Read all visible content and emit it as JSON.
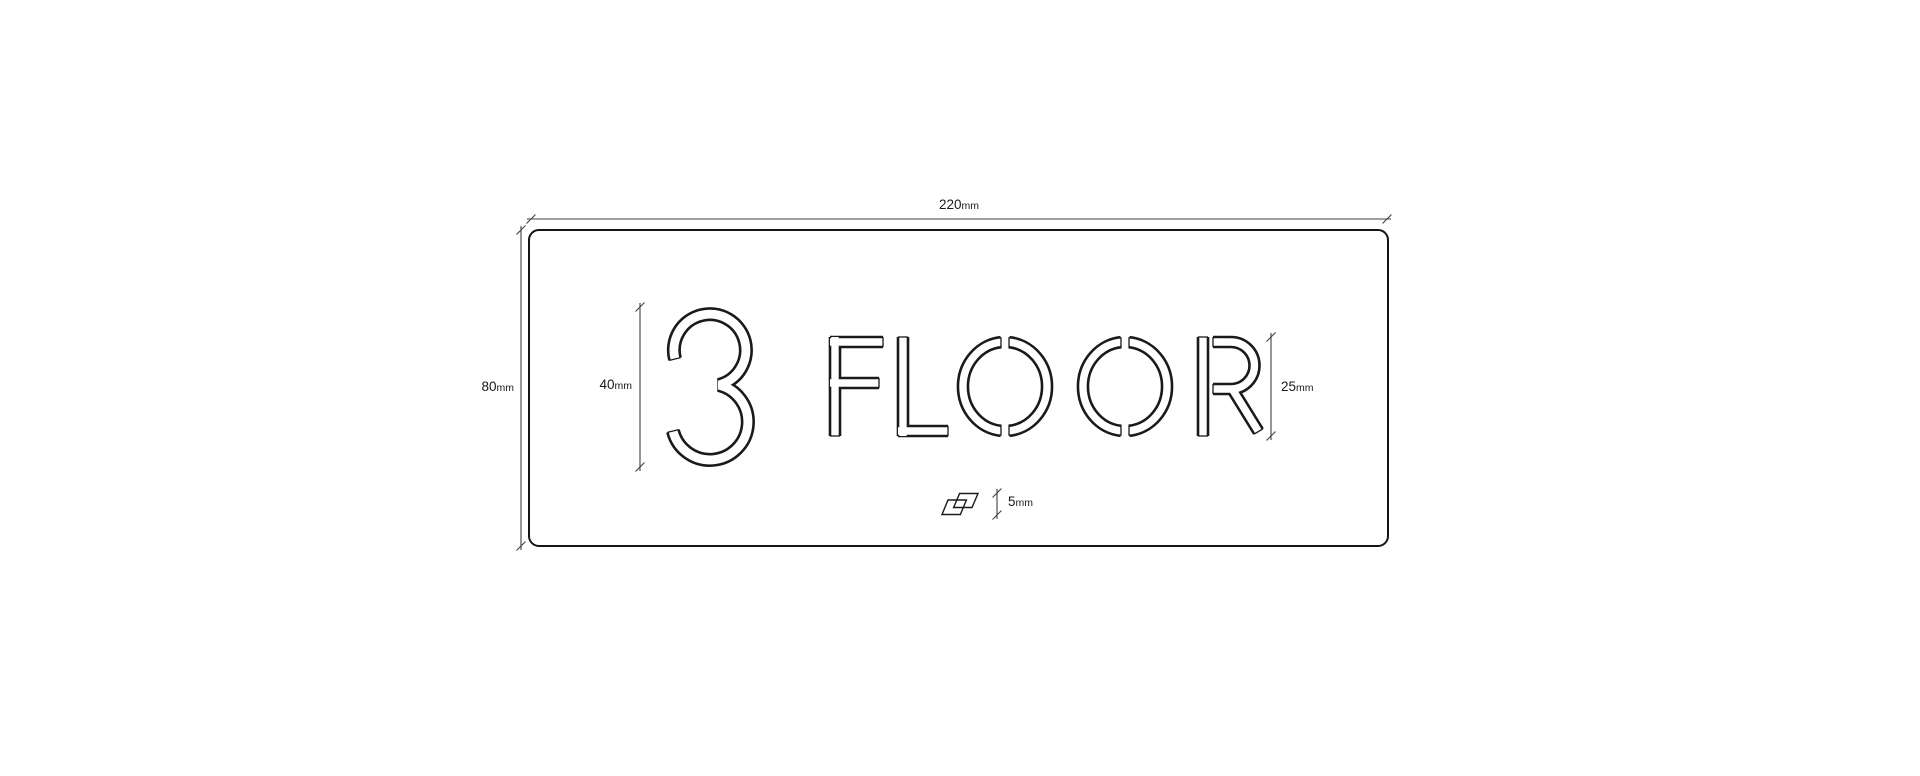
{
  "sign": {
    "number": "3",
    "label": "FLOOR"
  },
  "dimensions": {
    "plate_width": {
      "value": "220",
      "unit": "mm"
    },
    "plate_height": {
      "value": "80",
      "unit": "mm"
    },
    "number_height": {
      "value": "40",
      "unit": "mm"
    },
    "label_height": {
      "value": "25",
      "unit": "mm"
    },
    "logo_height": {
      "value": "5",
      "unit": "mm"
    }
  },
  "colors": {
    "outline": "#1a1a1a",
    "dimension": "#3f3f3f",
    "plate_fill": "#ffffff",
    "background": "#ffffff"
  }
}
